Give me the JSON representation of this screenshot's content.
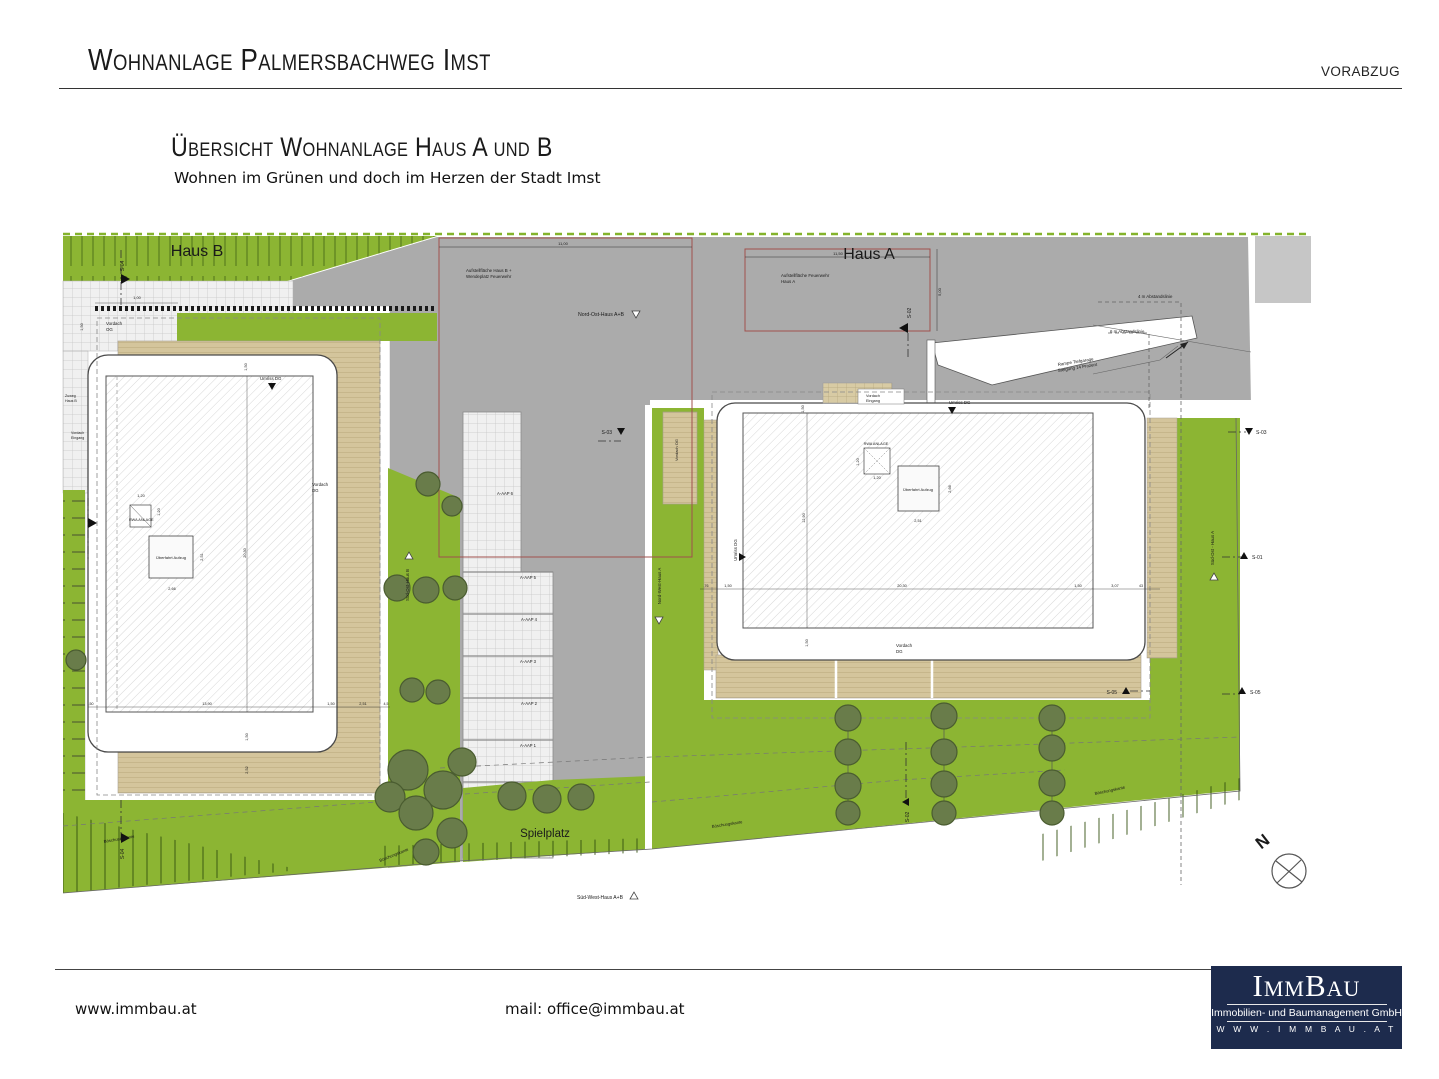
{
  "header": {
    "title": "Wohnanlage Palmersbachweg Imst",
    "proof_stamp": "VORABZUG"
  },
  "subtitle": {
    "heading": "Übersicht Wohnanlage Haus A und B",
    "tagline": "Wohnen im Grünen und doch im Herzen der Stadt Imst"
  },
  "footer": {
    "website": "www.immbau.at",
    "email": "mail: office@immbau.at",
    "logo": {
      "name": "ImmBau",
      "subtitle": "Immobilien- und Baumanagement GmbH",
      "url": "W W W . I M M B A U . A T"
    }
  },
  "colors": {
    "grass": "#8CB533",
    "tree": "#697C4A",
    "road": "#ABABAB",
    "road_light": "#C6C6C6",
    "terrace": "#D4C59C",
    "paving": "#F0F0F0",
    "fire_area_red": "#A0504D",
    "logo_navy": "#1D2B4D"
  },
  "plan": {
    "labels": [
      {
        "t": "Haus B",
        "x": 197,
        "y": 256,
        "s": 16,
        "a": "m"
      },
      {
        "t": "Haus A",
        "x": 869,
        "y": 259,
        "s": 16,
        "a": "m"
      },
      {
        "t": "Aufstellfläche Haus B +",
        "x": 466,
        "y": 272,
        "s": 4.4,
        "a": "s"
      },
      {
        "t": "Wendeplatz Feuerwehr",
        "x": 466,
        "y": 278,
        "s": 4.4,
        "a": "s"
      },
      {
        "t": "11,00",
        "x": 563,
        "y": 245,
        "s": 4,
        "a": "m"
      },
      {
        "t": "Aufstellfläche Feuerwehr",
        "x": 781,
        "y": 277,
        "s": 4.4,
        "a": "s"
      },
      {
        "t": "Haus A",
        "x": 781,
        "y": 283,
        "s": 4.4,
        "a": "s"
      },
      {
        "t": "11,50",
        "x": 838,
        "y": 255,
        "s": 4,
        "a": "m"
      },
      {
        "t": "5,00",
        "x": 941,
        "y": 292,
        "s": 4,
        "r": -90,
        "a": "m"
      },
      {
        "t": "Nord-Ost-Haus A+B",
        "x": 578,
        "y": 316,
        "s": 5.2,
        "a": "s"
      },
      {
        "t": "4 m Abstandslinie",
        "x": 1138,
        "y": 298,
        "s": 4.4,
        "a": "s"
      },
      {
        "t": "6 m Abstandslinie",
        "x": 1110,
        "y": 333,
        "s": 4.4,
        "a": "s"
      },
      {
        "t": "Rampe Tiefgarage",
        "x": 1058,
        "y": 366,
        "s": 4.4,
        "r": -9,
        "a": "s"
      },
      {
        "t": "Steigung 14 Prozent",
        "x": 1058,
        "y": 372,
        "s": 4.4,
        "r": -9,
        "a": "s"
      },
      {
        "t": "S-04",
        "x": 124,
        "y": 266,
        "s": 5,
        "r": -90,
        "a": "m"
      },
      {
        "t": "S-02",
        "x": 911,
        "y": 313,
        "s": 5,
        "r": -90,
        "a": "m"
      },
      {
        "t": "S-03",
        "x": 612,
        "y": 434,
        "s": 5,
        "a": "e"
      },
      {
        "t": "S-03",
        "x": 1256,
        "y": 434,
        "s": 5,
        "a": "s"
      },
      {
        "t": "S-01",
        "x": 1252,
        "y": 559,
        "s": 5,
        "a": "s"
      },
      {
        "t": "S-05",
        "x": 1117,
        "y": 694,
        "s": 5,
        "a": "e"
      },
      {
        "t": "S-05",
        "x": 1250,
        "y": 694,
        "s": 5,
        "a": "s"
      },
      {
        "t": "S-02",
        "x": 909,
        "y": 817,
        "s": 5,
        "r": -90,
        "a": "m"
      },
      {
        "t": "S-04",
        "x": 124,
        "y": 854,
        "s": 5,
        "r": -90,
        "a": "m"
      },
      {
        "t": "Vordach",
        "x": 106,
        "y": 325,
        "s": 4.4,
        "a": "s"
      },
      {
        "t": "OG",
        "x": 106,
        "y": 331,
        "s": 4.4,
        "a": "s"
      },
      {
        "t": "1,00",
        "x": 137,
        "y": 299,
        "s": 3.8,
        "a": "m"
      },
      {
        "t": "1,50",
        "x": 83,
        "y": 327,
        "s": 3.8,
        "r": -90,
        "a": "m"
      },
      {
        "t": "Umriss DG",
        "x": 260,
        "y": 380,
        "s": 4.4,
        "a": "s"
      },
      {
        "t": "1,50",
        "x": 247,
        "y": 367,
        "s": 3.8,
        "r": -90,
        "a": "m"
      },
      {
        "t": "Zuweg",
        "x": 65,
        "y": 397,
        "s": 3.6,
        "a": "s"
      },
      {
        "t": "Haus B",
        "x": 65,
        "y": 402,
        "s": 3.6,
        "a": "s"
      },
      {
        "t": "Vordach",
        "x": 71,
        "y": 434,
        "s": 3.6,
        "a": "s"
      },
      {
        "t": "Eingang",
        "x": 71,
        "y": 439,
        "s": 3.6,
        "a": "s"
      },
      {
        "t": "RWA ANLAGE",
        "x": 129,
        "y": 521,
        "s": 3.8,
        "a": "s"
      },
      {
        "t": "1,20",
        "x": 141,
        "y": 497,
        "s": 3.8,
        "a": "m"
      },
      {
        "t": "1,20",
        "x": 160,
        "y": 512,
        "s": 3.8,
        "r": -90,
        "a": "m"
      },
      {
        "t": "Überfahrt Aufzug",
        "x": 171,
        "y": 559,
        "s": 4,
        "a": "m"
      },
      {
        "t": "2,66",
        "x": 172,
        "y": 590,
        "s": 3.8,
        "a": "m"
      },
      {
        "t": "2,51",
        "x": 203,
        "y": 557,
        "s": 3.8,
        "r": -90,
        "a": "m"
      },
      {
        "t": "20,30",
        "x": 246,
        "y": 553,
        "s": 3.8,
        "r": -90,
        "a": "m"
      },
      {
        "t": "Vordach",
        "x": 312,
        "y": 486,
        "s": 4.4,
        "a": "s"
      },
      {
        "t": "DG",
        "x": 312,
        "y": 492,
        "s": 4.4,
        "a": "s"
      },
      {
        "t": ",50",
        "x": 91,
        "y": 705,
        "s": 3.6,
        "a": "m"
      },
      {
        "t": "13,90",
        "x": 207,
        "y": 705,
        "s": 3.8,
        "a": "m"
      },
      {
        "t": "1,50",
        "x": 331,
        "y": 705,
        "s": 3.8,
        "a": "m"
      },
      {
        "t": "2,51",
        "x": 363,
        "y": 705,
        "s": 3.8,
        "a": "m"
      },
      {
        "t": "4,5",
        "x": 386,
        "y": 705,
        "s": 3.6,
        "a": "m"
      },
      {
        "t": "1,50",
        "x": 248,
        "y": 737,
        "s": 3.8,
        "r": -90,
        "a": "m"
      },
      {
        "t": "2,52",
        "x": 248,
        "y": 770,
        "s": 3.8,
        "r": -90,
        "a": "m"
      },
      {
        "t": "A-AAP 6",
        "x": 505,
        "y": 495,
        "s": 4.2,
        "a": "m"
      },
      {
        "t": "A-AAP 5",
        "x": 528,
        "y": 579,
        "s": 4.2,
        "a": "m"
      },
      {
        "t": "A-AAP 4",
        "x": 529,
        "y": 621,
        "s": 4.2,
        "a": "m"
      },
      {
        "t": "A-AAP 3",
        "x": 528,
        "y": 663,
        "s": 4.2,
        "a": "m"
      },
      {
        "t": "A-AAP 2",
        "x": 529,
        "y": 705,
        "s": 4.2,
        "a": "m"
      },
      {
        "t": "A-AAP 1",
        "x": 528,
        "y": 747,
        "s": 4.2,
        "a": "m"
      },
      {
        "t": "Süd-Ost-Haus B",
        "x": 409,
        "y": 585,
        "s": 4.4,
        "r": -90,
        "a": "m"
      },
      {
        "t": "Nord-West-Haus A",
        "x": 661,
        "y": 586,
        "s": 4.4,
        "r": -90,
        "a": "m"
      },
      {
        "t": "Vordach OG",
        "x": 678,
        "y": 450,
        "s": 4,
        "r": -90,
        "a": "m"
      },
      {
        "t": "Umriss DG",
        "x": 949,
        "y": 404,
        "s": 4.4,
        "a": "s"
      },
      {
        "t": "Umriss DG",
        "x": 737,
        "y": 550,
        "s": 4.4,
        "r": -90,
        "a": "m"
      },
      {
        "t": "RWA ANLAGE",
        "x": 876,
        "y": 445,
        "s": 3.8,
        "a": "m"
      },
      {
        "t": "1,20",
        "x": 859,
        "y": 462,
        "s": 3.8,
        "r": -90,
        "a": "m"
      },
      {
        "t": "1,20",
        "x": 877,
        "y": 479,
        "s": 3.8,
        "a": "m"
      },
      {
        "t": "Überfahrt Aufzug",
        "x": 918,
        "y": 491,
        "s": 4,
        "a": "m"
      },
      {
        "t": "2,66",
        "x": 951,
        "y": 489,
        "s": 3.8,
        "r": -90,
        "a": "m"
      },
      {
        "t": "2,51",
        "x": 918,
        "y": 522,
        "s": 3.8,
        "a": "m"
      },
      {
        "t": "12,90",
        "x": 805,
        "y": 518,
        "s": 3.8,
        "r": -90,
        "a": "m"
      },
      {
        "t": "1,50",
        "x": 804,
        "y": 409,
        "s": 3.8,
        "r": -90,
        "a": "m"
      },
      {
        "t": ",76",
        "x": 706,
        "y": 587,
        "s": 3.6,
        "a": "m"
      },
      {
        "t": "1,50",
        "x": 728,
        "y": 587,
        "s": 3.8,
        "a": "m"
      },
      {
        "t": "20,30",
        "x": 902,
        "y": 587,
        "s": 3.8,
        "a": "m"
      },
      {
        "t": "1,50",
        "x": 1078,
        "y": 587,
        "s": 3.8,
        "a": "m"
      },
      {
        "t": "3,07",
        "x": 1115,
        "y": 587,
        "s": 3.8,
        "a": "m"
      },
      {
        "t": "43",
        "x": 1141,
        "y": 587,
        "s": 3.6,
        "a": "m"
      },
      {
        "t": "1,50",
        "x": 808,
        "y": 643,
        "s": 3.8,
        "r": -90,
        "a": "m"
      },
      {
        "t": "Vordach",
        "x": 896,
        "y": 647,
        "s": 4.4,
        "a": "s"
      },
      {
        "t": "DG",
        "x": 896,
        "y": 653,
        "s": 4.4,
        "a": "s"
      },
      {
        "t": "Vordach",
        "x": 866,
        "y": 397,
        "s": 3.8,
        "a": "s"
      },
      {
        "t": "Eingang",
        "x": 866,
        "y": 402,
        "s": 3.8,
        "a": "s"
      },
      {
        "t": "Süd-Ost - Haus A",
        "x": 1214,
        "y": 548,
        "s": 4.4,
        "r": -90,
        "a": "m"
      },
      {
        "t": "Spielplatz",
        "x": 545,
        "y": 837,
        "s": 11.5,
        "a": "m"
      },
      {
        "t": "Böschungskante",
        "x": 104,
        "y": 843,
        "s": 4.2,
        "r": -10,
        "a": "s"
      },
      {
        "t": "Böschungskante",
        "x": 380,
        "y": 862,
        "s": 4.2,
        "r": -22,
        "a": "s"
      },
      {
        "t": "Böschungskante",
        "x": 712,
        "y": 828,
        "s": 4.2,
        "r": -9,
        "a": "s"
      },
      {
        "t": "Böschungskante",
        "x": 1095,
        "y": 795,
        "s": 4.2,
        "r": -12,
        "a": "s"
      },
      {
        "t": "Süd-West-Haus A+B",
        "x": 577,
        "y": 899,
        "s": 5,
        "a": "s"
      },
      {
        "t": "N",
        "x": 1266,
        "y": 846,
        "s": 17,
        "r": -38,
        "a": "m",
        "w": "bold"
      }
    ],
    "markers": [
      {
        "k": "fr",
        "x": 121,
        "y": 280
      },
      {
        "k": "fr",
        "x": 88,
        "y": 524
      },
      {
        "k": "fr",
        "x": 121,
        "y": 839
      },
      {
        "k": "fl",
        "x": 908,
        "y": 329
      },
      {
        "k": "tl",
        "x": 906,
        "y": 802
      },
      {
        "k": "td",
        "x": 272,
        "y": 386
      },
      {
        "k": "td",
        "x": 952,
        "y": 410
      },
      {
        "k": "tr",
        "x": 742,
        "y": 557
      },
      {
        "k": "td",
        "x": 621,
        "y": 431
      },
      {
        "k": "td",
        "x": 1249,
        "y": 431
      },
      {
        "k": "tu",
        "x": 1244,
        "y": 556
      },
      {
        "k": "tu",
        "x": 1126,
        "y": 691
      },
      {
        "k": "tu",
        "x": 1242,
        "y": 691
      },
      {
        "k": "wd",
        "x": 636,
        "y": 314
      },
      {
        "k": "wd",
        "x": 659,
        "y": 620
      },
      {
        "k": "wu",
        "x": 409,
        "y": 556
      },
      {
        "k": "wu",
        "x": 1214,
        "y": 577
      },
      {
        "k": "wu",
        "x": 634,
        "y": 896
      },
      {
        "k": "ar",
        "x": 1188,
        "y": 342
      }
    ],
    "trees": [
      {
        "x": 428,
        "y": 484,
        "r": 12
      },
      {
        "x": 452,
        "y": 506,
        "r": 10
      },
      {
        "x": 397,
        "y": 588,
        "r": 13
      },
      {
        "x": 426,
        "y": 590,
        "r": 13
      },
      {
        "x": 455,
        "y": 588,
        "r": 12
      },
      {
        "x": 412,
        "y": 690,
        "r": 12
      },
      {
        "x": 438,
        "y": 692,
        "r": 12
      },
      {
        "x": 76,
        "y": 660,
        "r": 10
      },
      {
        "x": 462,
        "y": 762,
        "r": 14
      },
      {
        "x": 408,
        "y": 770,
        "r": 20
      },
      {
        "x": 443,
        "y": 790,
        "r": 19
      },
      {
        "x": 390,
        "y": 797,
        "r": 15
      },
      {
        "x": 416,
        "y": 813,
        "r": 17
      },
      {
        "x": 452,
        "y": 833,
        "r": 15
      },
      {
        "x": 426,
        "y": 852,
        "r": 13
      },
      {
        "x": 512,
        "y": 796,
        "r": 14
      },
      {
        "x": 547,
        "y": 799,
        "r": 14
      },
      {
        "x": 581,
        "y": 797,
        "r": 13
      },
      {
        "x": 848,
        "y": 718,
        "r": 13
      },
      {
        "x": 848,
        "y": 752,
        "r": 13
      },
      {
        "x": 848,
        "y": 786,
        "r": 13
      },
      {
        "x": 848,
        "y": 813,
        "r": 12
      },
      {
        "x": 944,
        "y": 716,
        "r": 13
      },
      {
        "x": 944,
        "y": 752,
        "r": 13
      },
      {
        "x": 944,
        "y": 784,
        "r": 13
      },
      {
        "x": 944,
        "y": 813,
        "r": 12
      },
      {
        "x": 1052,
        "y": 718,
        "r": 13
      },
      {
        "x": 1052,
        "y": 748,
        "r": 13
      },
      {
        "x": 1052,
        "y": 783,
        "r": 13
      },
      {
        "x": 1052,
        "y": 813,
        "r": 12
      }
    ]
  }
}
